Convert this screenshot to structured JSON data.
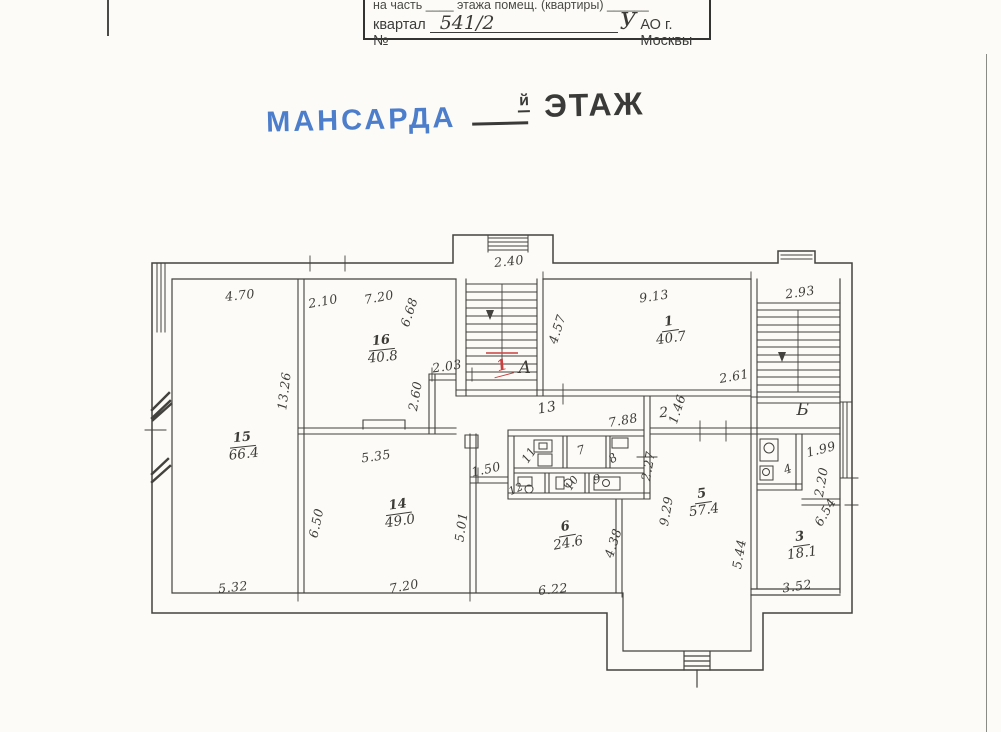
{
  "header": {
    "line1": "на часть ____ этажа помещ. (квартиры) ______",
    "line2_label": "квартал №",
    "line2_value": "541/2",
    "okrug_letter": "У",
    "line2_suffix": "АО г. Москвы"
  },
  "title": {
    "left": "МАНСАРДА",
    "small": "й",
    "right": "ЭТАЖ"
  },
  "colors": {
    "accent_blue": "#4d7ecb",
    "ink": "#3f3d38",
    "red": "#c9403f"
  },
  "plan": {
    "red_mark": {
      "text": "1",
      "x": 502,
      "y": 366,
      "rot": -15
    },
    "rooms": [
      {
        "n": "15",
        "a": "66.4",
        "x": 243,
        "y": 447,
        "rot": -6
      },
      {
        "n": "16",
        "a": "40.8",
        "x": 382,
        "y": 350,
        "rot": -6
      },
      {
        "n": "14",
        "a": "49.0",
        "x": 399,
        "y": 514,
        "rot": -8
      },
      {
        "n": "1",
        "a": "40.7",
        "x": 670,
        "y": 331,
        "rot": -8
      },
      {
        "n": "5",
        "a": "57.4",
        "x": 703,
        "y": 503,
        "rot": -8
      },
      {
        "n": "6",
        "a": "24.6",
        "x": 567,
        "y": 536,
        "rot": -10
      },
      {
        "n": "3",
        "a": "18.1",
        "x": 801,
        "y": 546,
        "rot": -8
      }
    ],
    "labels": [
      {
        "t": "13",
        "x": 547,
        "y": 408,
        "rot": -10,
        "size": 14
      },
      {
        "t": "2",
        "x": 664,
        "y": 413,
        "rot": -5,
        "size": 14
      },
      {
        "t": "11",
        "x": 529,
        "y": 455,
        "rot": -55,
        "size": 12
      },
      {
        "t": "7",
        "x": 581,
        "y": 450,
        "rot": -15,
        "size": 12
      },
      {
        "t": "8",
        "x": 613,
        "y": 458,
        "rot": -35,
        "size": 12
      },
      {
        "t": "9",
        "x": 597,
        "y": 479,
        "rot": -15,
        "size": 12
      },
      {
        "t": "10",
        "x": 572,
        "y": 483,
        "rot": -55,
        "size": 11
      },
      {
        "t": "12",
        "x": 516,
        "y": 489,
        "rot": -25,
        "size": 11
      },
      {
        "t": "4",
        "x": 788,
        "y": 469,
        "rot": -20,
        "size": 12
      },
      {
        "t": "А",
        "x": 525,
        "y": 368,
        "rot": 0,
        "size": 17
      },
      {
        "t": "Б",
        "x": 803,
        "y": 410,
        "rot": 0,
        "size": 17
      }
    ],
    "dimensions": [
      {
        "t": "4.70",
        "x": 240,
        "y": 295,
        "rot": -6
      },
      {
        "t": "2.10",
        "x": 323,
        "y": 301,
        "rot": -10
      },
      {
        "t": "7.20",
        "x": 379,
        "y": 297,
        "rot": -10
      },
      {
        "t": "6.68",
        "x": 409,
        "y": 312,
        "rot": -72
      },
      {
        "t": "13.26",
        "x": 284,
        "y": 391,
        "rot": -83
      },
      {
        "t": "2.03",
        "x": 447,
        "y": 366,
        "rot": -8
      },
      {
        "t": "2.60",
        "x": 415,
        "y": 396,
        "rot": -80
      },
      {
        "t": "5.35",
        "x": 376,
        "y": 456,
        "rot": -8
      },
      {
        "t": "1.50",
        "x": 486,
        "y": 469,
        "rot": -12
      },
      {
        "t": "6.50",
        "x": 316,
        "y": 523,
        "rot": -78
      },
      {
        "t": "5.01",
        "x": 461,
        "y": 527,
        "rot": -82
      },
      {
        "t": "5.32",
        "x": 233,
        "y": 587,
        "rot": -6
      },
      {
        "t": "7.20",
        "x": 404,
        "y": 586,
        "rot": -10
      },
      {
        "t": "6.22",
        "x": 553,
        "y": 589,
        "rot": -6
      },
      {
        "t": "4.38",
        "x": 613,
        "y": 543,
        "rot": -72
      },
      {
        "t": "9.29",
        "x": 666,
        "y": 511,
        "rot": -80
      },
      {
        "t": "5.44",
        "x": 739,
        "y": 554,
        "rot": -80
      },
      {
        "t": "3.52",
        "x": 797,
        "y": 586,
        "rot": -8
      },
      {
        "t": "2.40",
        "x": 509,
        "y": 261,
        "rot": -6
      },
      {
        "t": "4.57",
        "x": 557,
        "y": 329,
        "rot": -72
      },
      {
        "t": "9.13",
        "x": 654,
        "y": 296,
        "rot": -8
      },
      {
        "t": "2.93",
        "x": 800,
        "y": 292,
        "rot": -8
      },
      {
        "t": "2.61",
        "x": 734,
        "y": 376,
        "rot": -10
      },
      {
        "t": "7.88",
        "x": 623,
        "y": 420,
        "rot": -10
      },
      {
        "t": "1.46",
        "x": 677,
        "y": 409,
        "rot": -72
      },
      {
        "t": "2.27",
        "x": 648,
        "y": 466,
        "rot": -80
      },
      {
        "t": "1.99",
        "x": 821,
        "y": 449,
        "rot": -14
      },
      {
        "t": "2.20",
        "x": 821,
        "y": 482,
        "rot": -80
      },
      {
        "t": "6.54",
        "x": 825,
        "y": 512,
        "rot": -60
      }
    ]
  }
}
